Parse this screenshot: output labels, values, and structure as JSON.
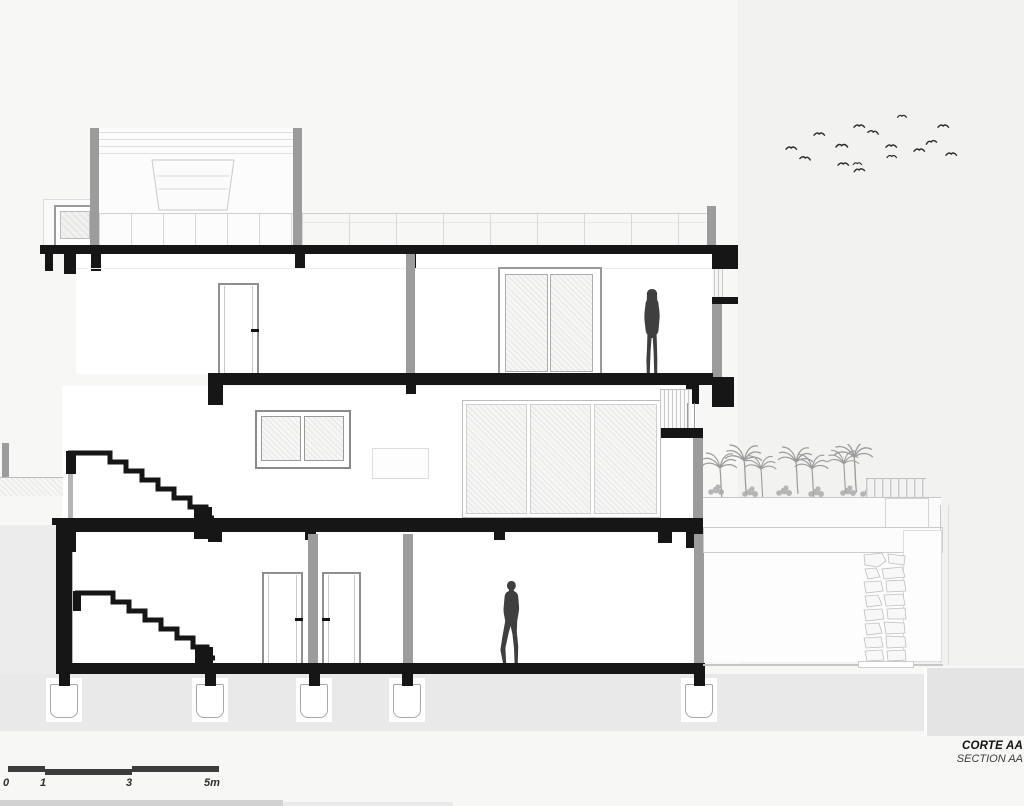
{
  "drawing": {
    "type": "architectural-section",
    "title": {
      "primary": "CORTE AA",
      "secondary": "SECTION AA"
    },
    "scale_bar": {
      "labels": [
        "0",
        "1",
        "3",
        "5m"
      ],
      "unit": "m"
    },
    "figures": [
      "woman-on-upper-floor",
      "man-on-ground-floor"
    ],
    "vegetation": "palm-roof-garden",
    "birds": "flock-top-right",
    "colors": {
      "ink": "#161616",
      "cut_wall_gray": "#9c9c9c",
      "soil_gray": "#e9e9e9",
      "light_line": "#c9c9c9",
      "figure_gray": "#3f3f3f",
      "background": "#f7f7f6"
    }
  }
}
